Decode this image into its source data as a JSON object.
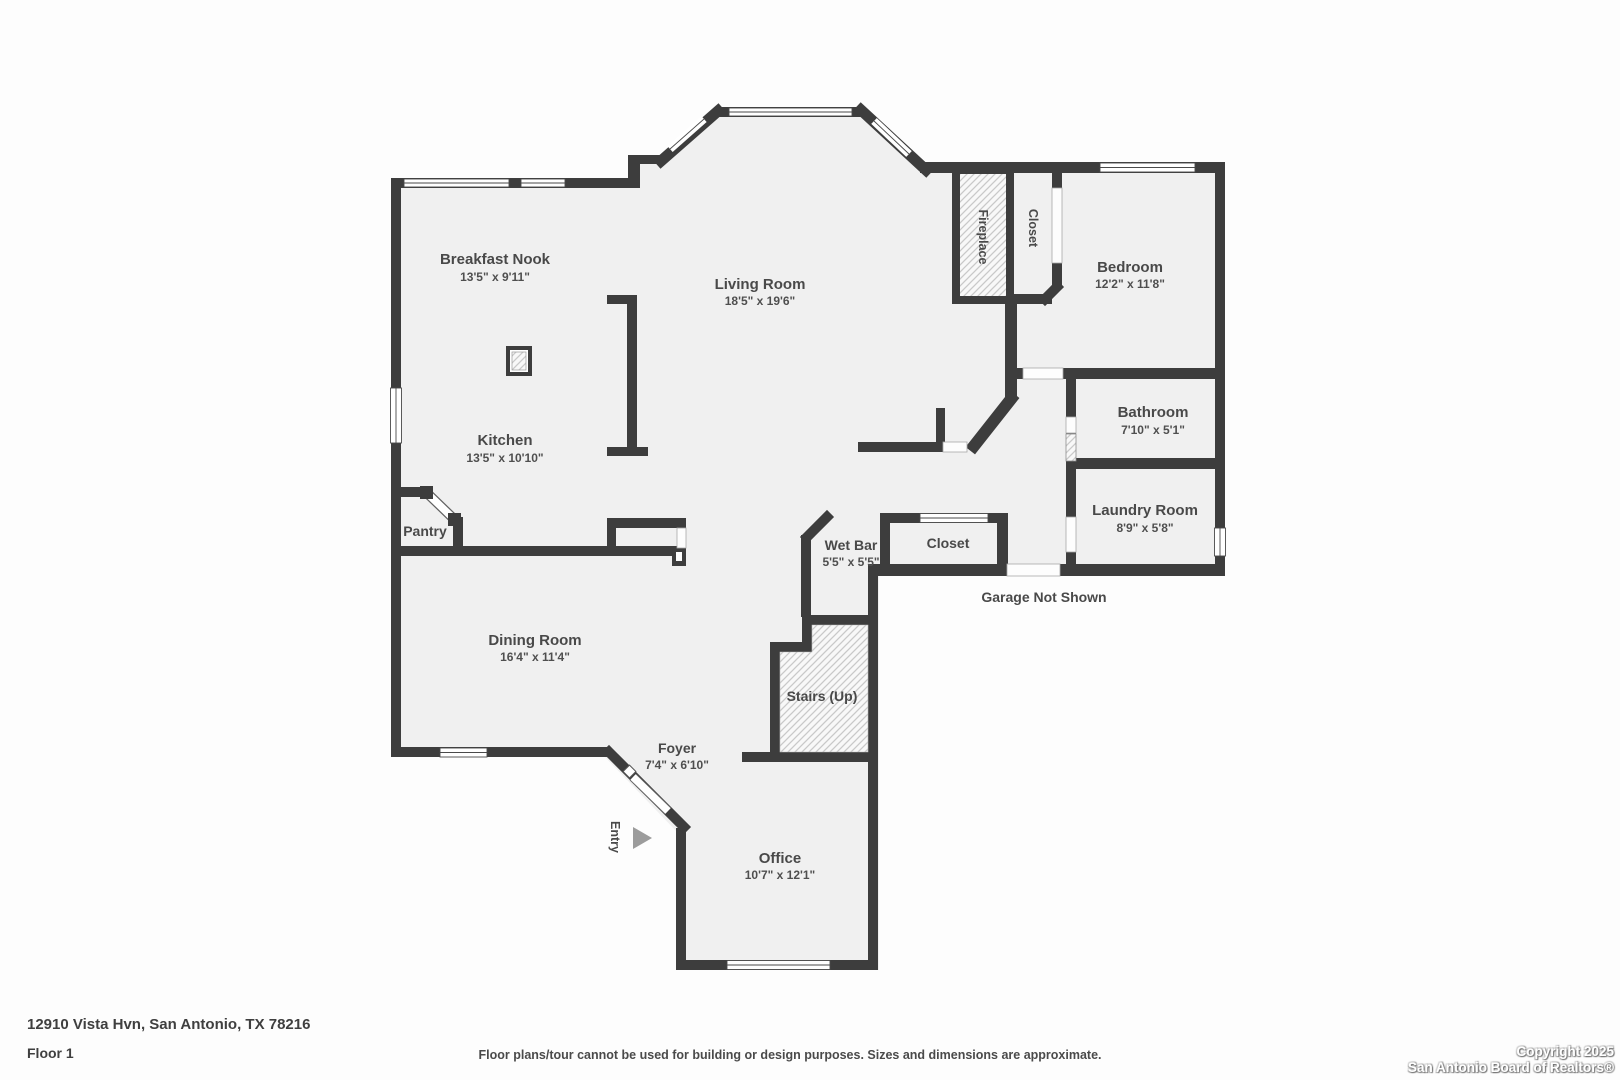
{
  "rooms": {
    "breakfast_nook": {
      "name": "Breakfast Nook",
      "dims": "13'5\" x 9'11\""
    },
    "living_room": {
      "name": "Living Room",
      "dims": "18'5\" x 19'6\""
    },
    "kitchen": {
      "name": "Kitchen",
      "dims": "13'5\" x 10'10\""
    },
    "bedroom": {
      "name": "Bedroom",
      "dims": "12'2\" x 11'8\""
    },
    "bathroom": {
      "name": "Bathroom",
      "dims": "7'10\" x 5'1\""
    },
    "laundry": {
      "name": "Laundry Room",
      "dims": "8'9\" x 5'8\""
    },
    "dining": {
      "name": "Dining Room",
      "dims": "16'4\" x 11'4\""
    },
    "foyer": {
      "name": "Foyer",
      "dims": "7'4\" x 6'10\""
    },
    "office": {
      "name": "Office",
      "dims": "10'7\" x 12'1\""
    },
    "wet_bar": {
      "name": "Wet Bar",
      "dims": "5'5\" x 5'5\""
    },
    "stairs": {
      "name": "Stairs (Up)"
    },
    "pantry": {
      "name": "Pantry"
    },
    "fireplace": {
      "name": "Fireplace"
    },
    "closet_bedroom": {
      "name": "Closet"
    },
    "closet_hall": {
      "name": "Closet"
    },
    "entry": {
      "name": "Entry"
    },
    "garage_note": "Garage Not Shown"
  },
  "icons": {
    "entry_arrow": "triangle-right"
  },
  "footer": {
    "address": "12910 Vista Hvn, San Antonio, TX 78216",
    "floor": "Floor 1",
    "disclaimer": "Floor plans/tour cannot be used for building or design purposes. Sizes and dimensions are approximate.",
    "copyright_line1": "Copyright 2025",
    "copyright_line2": "San Antonio Board of Realtors®"
  },
  "colors": {
    "wall": "#3d3d3d",
    "floor": "#f0f0f0",
    "label_text": "#4a4a4a",
    "hatch_line": "#c9c9c9",
    "entry_arrow": "#9c9c9c",
    "background": "#fdfdfd"
  }
}
